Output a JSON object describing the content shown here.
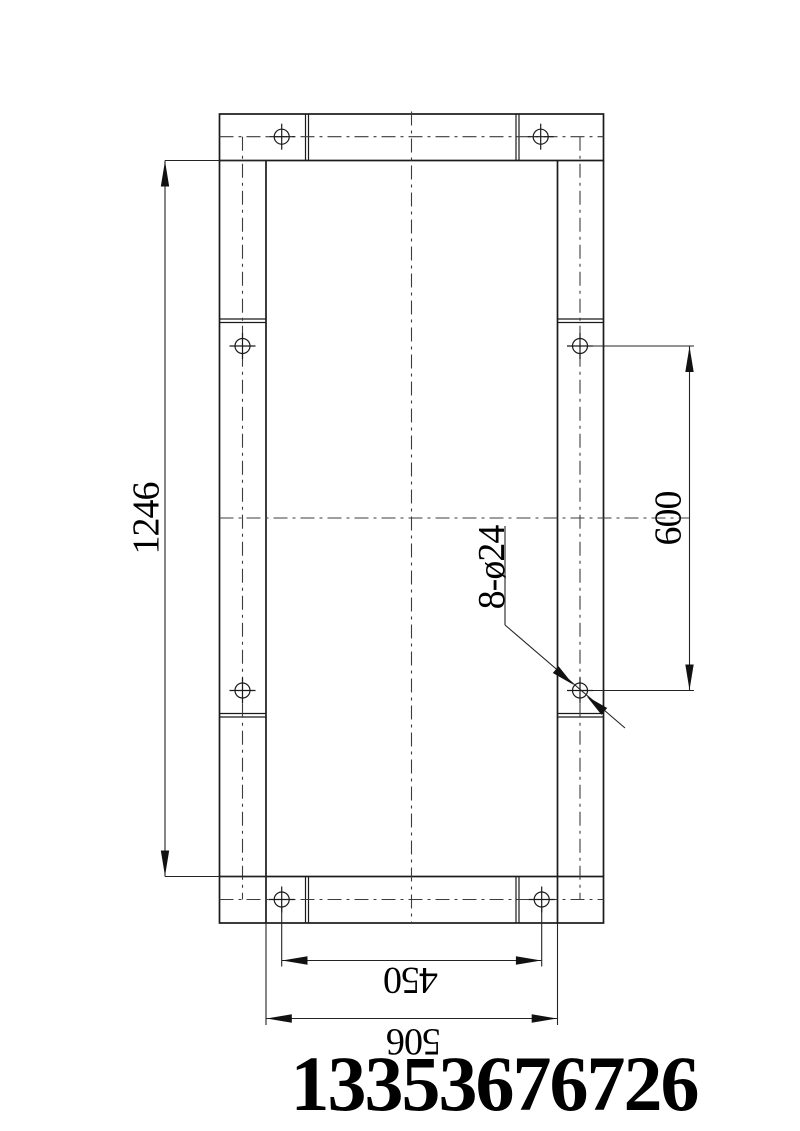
{
  "drawing": {
    "type": "engineering-drawing-base-frame-top-view",
    "background_color": "#ffffff",
    "line_color": "#1b1b1b",
    "centerline_color": "#3c3c3c",
    "hole_count": 8,
    "dimensions": {
      "overall_height": "1246",
      "side_hole_spacing": "600",
      "bottom_hole_spacing": "450",
      "overall_width": "506",
      "hole_callout": "8-ø24"
    },
    "footer": {
      "phone_number": "13353676726"
    }
  }
}
